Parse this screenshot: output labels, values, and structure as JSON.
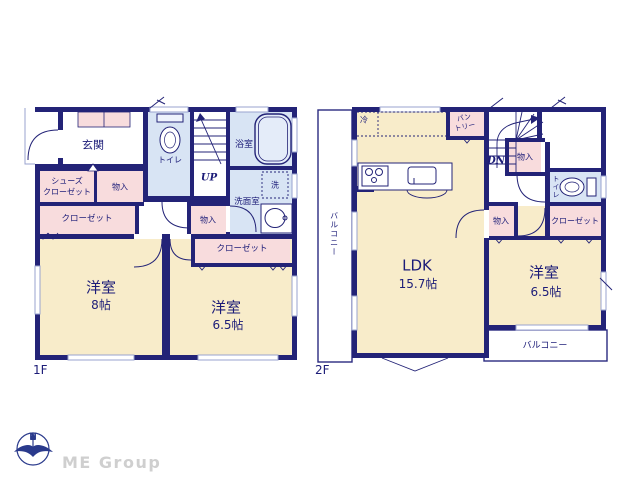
{
  "colors": {
    "wall_navy": "#232377",
    "room_cream": "#f8ecca",
    "closet_pink": "#f8dcdd",
    "wet_blue": "#d8e4f4",
    "text_navy": "#1c1c78",
    "brand_gray": "#cfcfcf"
  },
  "floor1": {
    "floor_label": "1F",
    "genkan": "玄関",
    "toilet": "トイレ",
    "stairs_up": "UP",
    "bath": "浴室",
    "laundry": "洗",
    "washroom": "洗面室",
    "shoes_closet_line1": "シューズ",
    "shoes_closet_line2": "クローゼット",
    "storage_top": "物入",
    "closet_left": "クローゼット",
    "storage_mid": "物入",
    "closet_right": "クローゼット",
    "bedroom1_name": "洋室",
    "bedroom1_size": "8帖",
    "bedroom2_name": "洋室",
    "bedroom2_size": "6.5帖"
  },
  "floor2": {
    "floor_label": "2F",
    "fridge": "冷",
    "pantry_line1": "パン",
    "pantry_line2": "トリー",
    "stairs_down": "DN",
    "storage_upper": "物入",
    "toilet": "トイレ",
    "closet": "クローゼット",
    "storage_lower": "物入",
    "balcony_left": "バルコニー",
    "ldk_name": "LDK",
    "ldk_size": "15.7帖",
    "bedroom_name": "洋室",
    "bedroom_size": "6.5帖",
    "balcony_bottom": "バルコニー"
  },
  "footer": {
    "compass_n": "N",
    "brand": "ME Group"
  }
}
